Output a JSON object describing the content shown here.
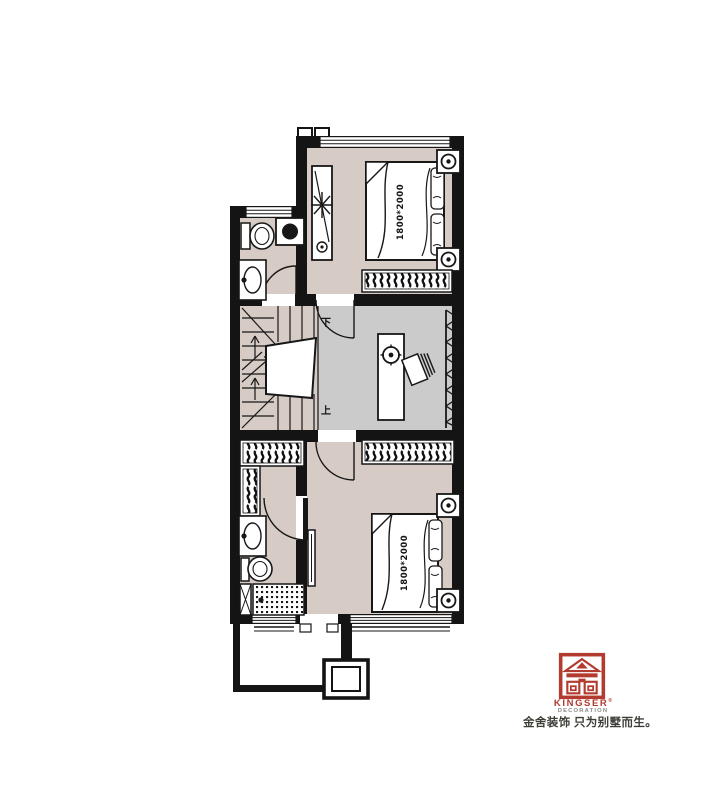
{
  "plan": {
    "colors": {
      "wall": "#141414",
      "room_floor": "#d7ccc5",
      "hall_floor": "#cbcbcb",
      "line": "#171717"
    },
    "top_bedroom": {
      "bed_label": "1800*2000"
    },
    "bottom_bedroom": {
      "bed_label": "1800*2000"
    },
    "stairs": {
      "down_label": "下",
      "up_label": "上"
    }
  },
  "branding": {
    "brand": "KINGSER",
    "registered": "®",
    "division": "DECORATION",
    "tagline": "金舍装饰 只为别墅而生。",
    "brand_color": "#b23a2e",
    "division_color": "#8b8b85",
    "tagline_color": "#3e3e38"
  }
}
